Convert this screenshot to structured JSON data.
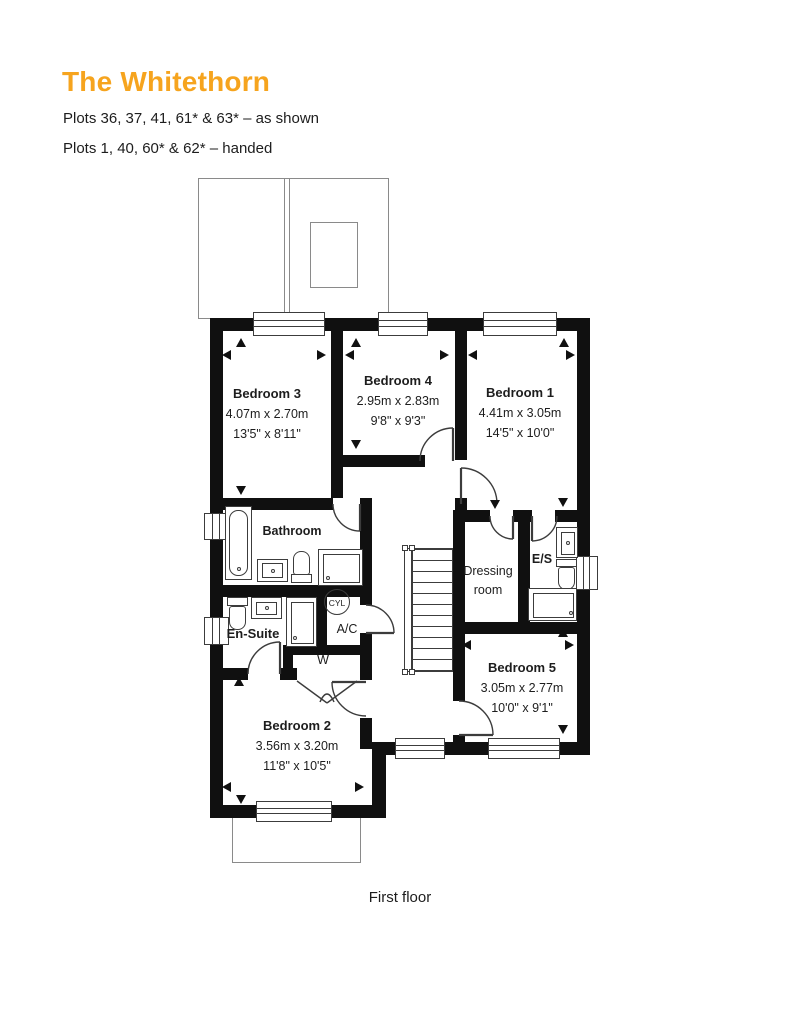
{
  "header": {
    "title": "The Whitethorn",
    "plots_as_shown": "Plots 36, 37, 41, 61* & 63* – as shown",
    "plots_handed": "Plots 1, 40, 60* & 62* – handed",
    "accent_color": "#F6A41E"
  },
  "floor_caption": "First floor",
  "rooms": {
    "bedroom1": {
      "name": "Bedroom 1",
      "metric": "4.41m x 3.05m",
      "imperial": "14'5\" x 10'0\""
    },
    "bedroom2": {
      "name": "Bedroom 2",
      "metric": "3.56m x 3.20m",
      "imperial": "11'8\" x 10'5\""
    },
    "bedroom3": {
      "name": "Bedroom 3",
      "metric": "4.07m x 2.70m",
      "imperial": "13'5\" x 8'11\""
    },
    "bedroom4": {
      "name": "Bedroom 4",
      "metric": "2.95m x 2.83m",
      "imperial": "9'8\" x 9'3\""
    },
    "bedroom5": {
      "name": "Bedroom 5",
      "metric": "3.05m x 2.77m",
      "imperial": "10'0\" x 9'1\""
    },
    "bathroom": {
      "name": "Bathroom"
    },
    "ensuite": {
      "name": "En-Suite"
    },
    "dressing_room": {
      "name": "Dressing room"
    },
    "es": {
      "name": "E/S"
    }
  },
  "labels": {
    "cylinder": "CYL",
    "airing_cupboard": "A/C",
    "wardrobe": "W"
  }
}
